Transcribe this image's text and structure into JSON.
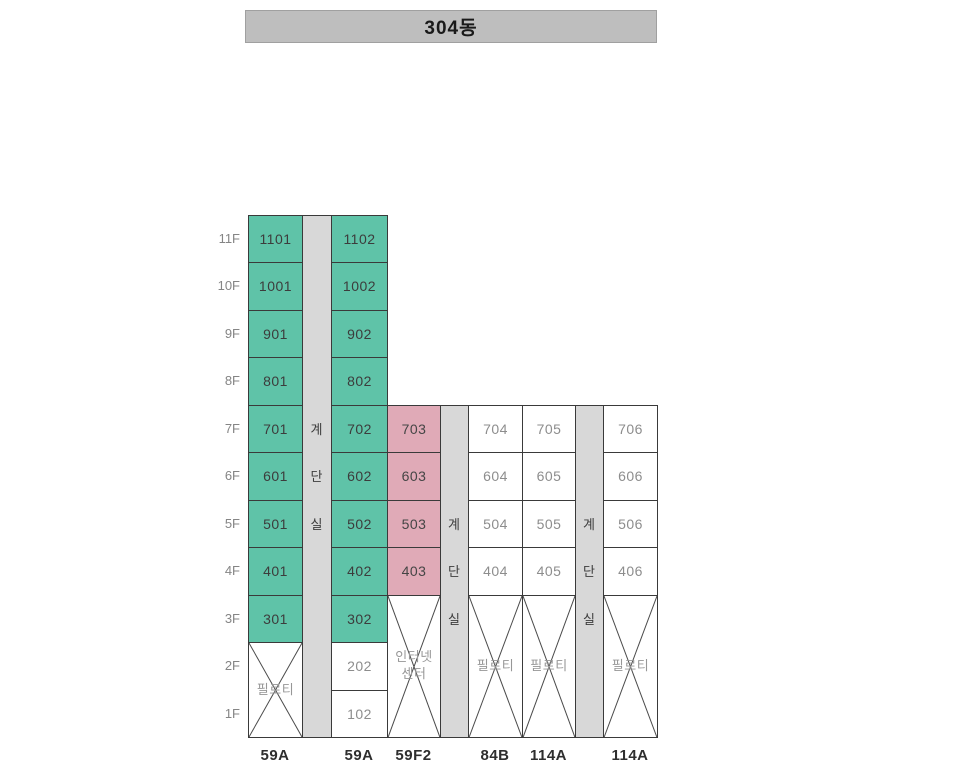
{
  "header": {
    "title": "304동"
  },
  "floor_labels": [
    "11F",
    "10F",
    "9F",
    "8F",
    "7F",
    "6F",
    "5F",
    "4F",
    "3F",
    "2F",
    "1F"
  ],
  "colors": {
    "teal": "#5fc3a8",
    "pink": "#e0aab7",
    "stair_gray": "#d8d8d8",
    "title_gray": "#bebebe",
    "grid_line": "#3a3a3a"
  },
  "stairwells": [
    {
      "name": "stairwell-1",
      "top_floor": "11F",
      "labels": [
        {
          "text": "계",
          "floor": "7F"
        },
        {
          "text": "단",
          "floor": "6F"
        },
        {
          "text": "실",
          "floor": "5F"
        }
      ]
    },
    {
      "name": "stairwell-2",
      "top_floor": "7F",
      "labels": [
        {
          "text": "계",
          "floor": "5F"
        },
        {
          "text": "단",
          "floor": "4F"
        },
        {
          "text": "실",
          "floor": "3F"
        }
      ]
    },
    {
      "name": "stairwell-3",
      "top_floor": "7F",
      "labels": [
        {
          "text": "계",
          "floor": "5F"
        },
        {
          "text": "단",
          "floor": "4F"
        },
        {
          "text": "실",
          "floor": "3F"
        }
      ]
    }
  ],
  "unit_columns": [
    {
      "type_label": "59A",
      "cells": [
        {
          "unit": "1101",
          "floor": "11F",
          "color": "teal"
        },
        {
          "unit": "1001",
          "floor": "10F",
          "color": "teal"
        },
        {
          "unit": "901",
          "floor": "9F",
          "color": "teal"
        },
        {
          "unit": "801",
          "floor": "8F",
          "color": "teal"
        },
        {
          "unit": "701",
          "floor": "7F",
          "color": "teal"
        },
        {
          "unit": "601",
          "floor": "6F",
          "color": "teal"
        },
        {
          "unit": "501",
          "floor": "5F",
          "color": "teal"
        },
        {
          "unit": "401",
          "floor": "4F",
          "color": "teal"
        },
        {
          "unit": "301",
          "floor": "3F",
          "color": "teal"
        }
      ],
      "special": {
        "name": "piloti-cell",
        "label_lines": [
          "필로티"
        ],
        "from_floor": "2F",
        "to_floor": "1F",
        "crossed": true
      }
    },
    {
      "type_label": "59A",
      "cells": [
        {
          "unit": "1102",
          "floor": "11F",
          "color": "teal"
        },
        {
          "unit": "1002",
          "floor": "10F",
          "color": "teal"
        },
        {
          "unit": "902",
          "floor": "9F",
          "color": "teal"
        },
        {
          "unit": "802",
          "floor": "8F",
          "color": "teal"
        },
        {
          "unit": "702",
          "floor": "7F",
          "color": "teal"
        },
        {
          "unit": "602",
          "floor": "6F",
          "color": "teal"
        },
        {
          "unit": "502",
          "floor": "5F",
          "color": "teal"
        },
        {
          "unit": "402",
          "floor": "4F",
          "color": "teal"
        },
        {
          "unit": "302",
          "floor": "3F",
          "color": "teal"
        },
        {
          "unit": "202",
          "floor": "2F",
          "color": "white"
        },
        {
          "unit": "102",
          "floor": "1F",
          "color": "white"
        }
      ],
      "special": null
    },
    {
      "type_label": "59F2",
      "cells": [
        {
          "unit": "703",
          "floor": "7F",
          "color": "pink"
        },
        {
          "unit": "603",
          "floor": "6F",
          "color": "pink"
        },
        {
          "unit": "503",
          "floor": "5F",
          "color": "pink"
        },
        {
          "unit": "403",
          "floor": "4F",
          "color": "pink"
        }
      ],
      "special": {
        "name": "internet-center-cell",
        "label_lines": [
          "인터넷",
          "센터"
        ],
        "from_floor": "3F",
        "to_floor": "1F",
        "crossed": true
      }
    },
    {
      "type_label": "84B",
      "cells": [
        {
          "unit": "704",
          "floor": "7F",
          "color": "white"
        },
        {
          "unit": "604",
          "floor": "6F",
          "color": "white"
        },
        {
          "unit": "504",
          "floor": "5F",
          "color": "white"
        },
        {
          "unit": "404",
          "floor": "4F",
          "color": "white"
        }
      ],
      "special": {
        "name": "piloti-cell",
        "label_lines": [
          "필로티"
        ],
        "from_floor": "3F",
        "to_floor": "1F",
        "crossed": true
      }
    },
    {
      "type_label": "114A",
      "cells": [
        {
          "unit": "705",
          "floor": "7F",
          "color": "white"
        },
        {
          "unit": "605",
          "floor": "6F",
          "color": "white"
        },
        {
          "unit": "505",
          "floor": "5F",
          "color": "white"
        },
        {
          "unit": "405",
          "floor": "4F",
          "color": "white"
        }
      ],
      "special": {
        "name": "piloti-cell",
        "label_lines": [
          "필로티"
        ],
        "from_floor": "3F",
        "to_floor": "1F",
        "crossed": true
      }
    },
    {
      "type_label": "114A",
      "cells": [
        {
          "unit": "706",
          "floor": "7F",
          "color": "white"
        },
        {
          "unit": "606",
          "floor": "6F",
          "color": "white"
        },
        {
          "unit": "506",
          "floor": "5F",
          "color": "white"
        },
        {
          "unit": "406",
          "floor": "4F",
          "color": "white"
        }
      ],
      "special": {
        "name": "piloti-cell",
        "label_lines": [
          "필로티"
        ],
        "from_floor": "3F",
        "to_floor": "1F",
        "crossed": true
      }
    }
  ]
}
